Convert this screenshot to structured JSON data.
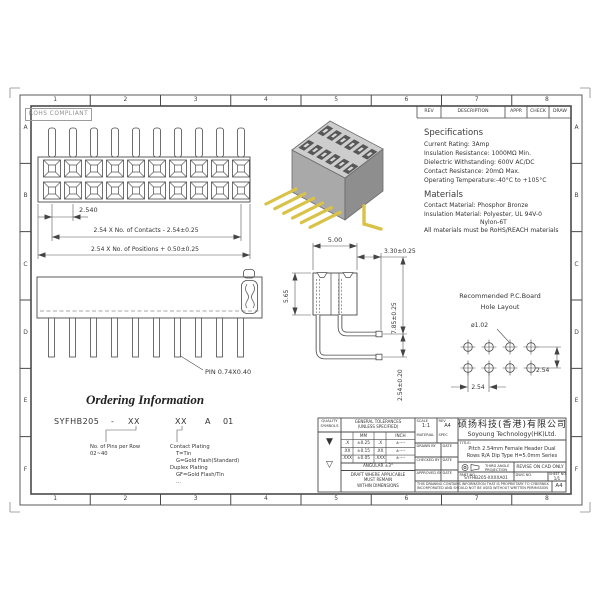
{
  "sheet": {
    "rohs": "ROHS COMPLIANT",
    "paper": "A4",
    "zones": {
      "cols": [
        "1",
        "2",
        "3",
        "4",
        "5",
        "6",
        "7",
        "8"
      ],
      "rows": [
        "A",
        "B",
        "C",
        "D",
        "E",
        "F"
      ]
    },
    "rev_table": {
      "rev": "REV",
      "description": "DESCRIPTION",
      "appr": "APPR",
      "check": "CHECK",
      "draw": "DRAW"
    }
  },
  "specs": {
    "title": "Specifications",
    "current": "Current Rating:  3Amp",
    "insulation": "Insulation Resistance: 1000MΩ Min.",
    "dielectric": "Dielectric Withstanding:  600V AC/DC",
    "contact": "Contact Resistance:  20mΩ Max.",
    "operating": "Operating Temperature:-40°C to +105°C"
  },
  "materials": {
    "title": "Materials",
    "contact": "Contact Material: Phosphor Bronze",
    "insulation": "Insulation Material: Polyester, UL 94V-0",
    "insulation2": "Nylon-6T",
    "note": "All materials must be RoHS/REACH materials"
  },
  "front_view": {
    "pitch": "2.540",
    "contacts_dim": "2.54 X No. of Contacts - 2.54±0.25",
    "positions_dim": "2.54 X No. of Positions + 0.50±0.25"
  },
  "side_view": {
    "width": "5.00",
    "tail": "3.30±0.25",
    "height": "5.65",
    "row1": "7.85±0.25",
    "row2": "2.54±0.20"
  },
  "bottom_view": {
    "pin": "PIN 0.74X0.40"
  },
  "hole_layout": {
    "title1": "Recommended P.C.Board",
    "title2": "Hole Layout",
    "dia": "ø1.02",
    "pitch_x": "2.54",
    "pitch_y": "2.54"
  },
  "ordering": {
    "title": "Ordering Information",
    "code": {
      "series": "SYFHB205",
      "dash": "-",
      "pins": "XX",
      "plating": "XX",
      "a": "A",
      "suffix": "01"
    },
    "pins_note": {
      "l1": "No. of Pins per Row",
      "l2": "02~40"
    },
    "plating_note": {
      "l1": "Contact Plating",
      "l2": "T=Tin",
      "l3": "G=Gold Flash(Standard)",
      "l4": "Duplex Plating",
      "l5": "GF=Gold Flash/Tin",
      "l6": "..."
    }
  },
  "title_block": {
    "quality": {
      "h1": "QUALITY",
      "h2": "SYMBOLS",
      "sym1": "▼",
      "sym2": "▽"
    },
    "tol": {
      "h1": "GENERAL TOLERANCES",
      "h2": "(UNLESS SPECIFIED)",
      "mm": "MM",
      "inch": "INCH",
      "r1": [
        ".X",
        "±0.25",
        ".X",
        "±----"
      ],
      "r2": [
        ".XX",
        "±0.15",
        ".XX",
        "±----"
      ],
      "r3": [
        ".XXX",
        "±0.05",
        ".XXX",
        "±----"
      ],
      "angular": "ANGULAR ±3°",
      "d1": "DRAFT WHERE APPLICABLE",
      "d2": "MUST REMAIN",
      "d3": "WITHIN DIMENSIONS"
    },
    "info": {
      "scale_l": "SCALE",
      "scale": "1:1",
      "rev_l": "REV",
      "rev": "A4",
      "material_l": "MATERIAL",
      "spec_l": "SPEC",
      "drawn_l": "DRAWN BY",
      "checked_l": "CHECKED BY",
      "approved_l": "APPROVED BY",
      "date_l": "DATE"
    },
    "company": {
      "cn": "硕扬科技(香港)有限公司",
      "en": "Soyoung Technology(HK)Ltd."
    },
    "title": {
      "label": "TITLE:",
      "l1": "Pitch 2.54mm Female Header Dual",
      "l2": "Rows R/A Dip Type H=5.0mm Series"
    },
    "proj": {
      "l1": "THIRD ANGLE",
      "l2": "PROJECTION",
      "revise": "REVISE ON CAD ONLY"
    },
    "part": {
      "label": "PART NO.",
      "value": "SYFHB205-XXXXA01",
      "dwg_l": "DWG NO.",
      "sheet_l": "SHEET NO.",
      "sheet": "1/1"
    },
    "disclaimer": {
      "l1": "THIS DRAWING CONTAINS INFORMATION THAT IS PROPRIETARY TO CYBERNEX",
      "l2": "INCORPORATED AND SHOULD NOT BE USED WITHOUT WRITTEN PERMISSION"
    }
  }
}
